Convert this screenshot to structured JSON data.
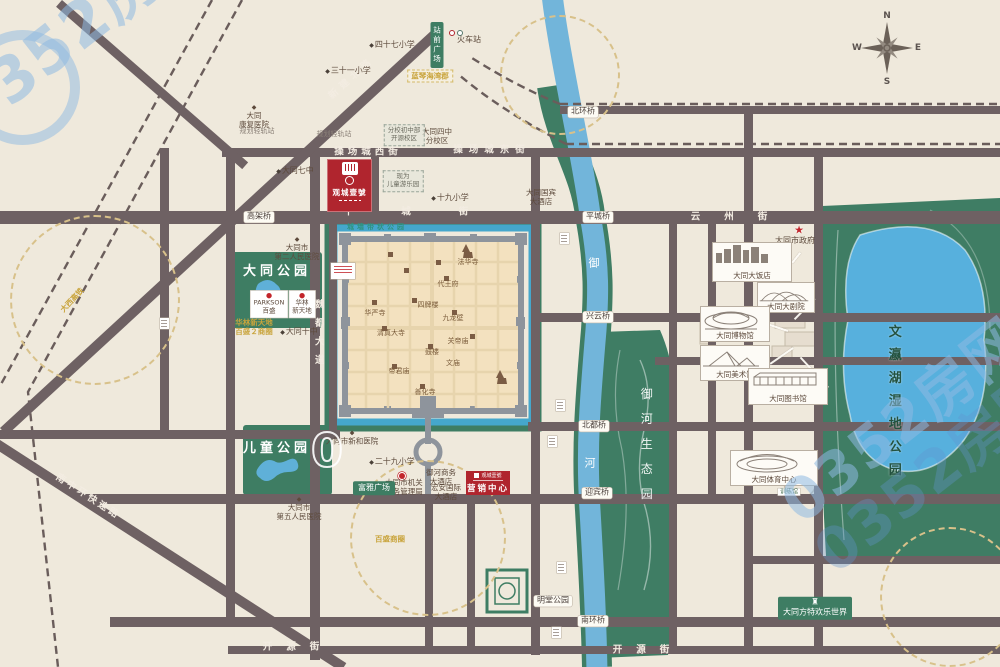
{
  "watermark": {
    "text": "0352房网",
    "zero": "0"
  },
  "compass": {
    "n": "N",
    "s": "S",
    "e": "E",
    "w": "W"
  },
  "project": {
    "name": "观城壹號",
    "marketing_label": "营销中心"
  },
  "map": {
    "labels": [
      {
        "k": "pill",
        "t": "北环桥",
        "x": 583,
        "y": 112,
        "n": "bridge-label-beihuan"
      },
      {
        "k": "pill",
        "t": "平城桥",
        "x": 598,
        "y": 217,
        "n": "bridge-label-pingcheng"
      },
      {
        "k": "pill",
        "t": "兴云桥",
        "x": 598,
        "y": 317,
        "n": "bridge-label-xingyun"
      },
      {
        "k": "pill",
        "t": "北都桥",
        "x": 594,
        "y": 426,
        "n": "bridge-label-beidu"
      },
      {
        "k": "pill",
        "t": "迎宾桥",
        "x": 597,
        "y": 493,
        "n": "bridge-label-yingbin"
      },
      {
        "k": "pill",
        "t": "南环桥",
        "x": 593,
        "y": 621,
        "n": "bridge-label-nanhuan"
      },
      {
        "k": "pill",
        "t": "明堂公园",
        "x": 553,
        "y": 601,
        "n": "mingtang-park-label"
      },
      {
        "k": "pill",
        "t": "高架桥",
        "x": 259,
        "y": 217,
        "n": "viaduct-label"
      },
      {
        "k": "roadtext",
        "t": "操场城西街",
        "x": 368,
        "y": 152,
        "ls": 4,
        "n": "road-name-caochangcheng-west"
      },
      {
        "k": "roadtext",
        "t": "操场城东街",
        "x": 492,
        "y": 150,
        "ls": 6,
        "n": "road-name-caochangcheng-east"
      },
      {
        "k": "roadtext",
        "t": "平城街",
        "x": 430,
        "y": 212,
        "ls": 48,
        "n": "road-name-pingcheng-street"
      },
      {
        "k": "roadtext",
        "t": "云州街",
        "x": 741,
        "y": 217,
        "ls": 24,
        "n": "road-name-yunzhou-street"
      },
      {
        "k": "roadtext",
        "t": "开源街",
        "x": 298,
        "y": 647,
        "ls": 14,
        "n": "road-name-kaiyuan-west"
      },
      {
        "k": "roadtext",
        "t": "开源街",
        "x": 648,
        "y": 650,
        "ls": 14,
        "n": "road-name-kaiyuan-east"
      },
      {
        "k": "roadtext",
        "t": "新建北路",
        "x": 352,
        "y": 78,
        "ls": 5,
        "r": -42,
        "n": "road-name-xinjian-north"
      },
      {
        "k": "roadtext",
        "t": "南中环快速路",
        "x": 88,
        "y": 497,
        "ls": 3,
        "r": 33,
        "n": "road-name-nanzhonghuan"
      },
      {
        "k": "vroad",
        "t": "魏都大道",
        "x": 318,
        "y": 336,
        "ls": 9,
        "n": "road-name-weidu-avenue"
      },
      {
        "k": "rivertext",
        "t": "御",
        "x": 594,
        "y": 263,
        "n": "river-name-yu"
      },
      {
        "k": "rivertext",
        "t": "河",
        "x": 590,
        "y": 463,
        "n": "river-name-he"
      },
      {
        "k": "greenvert",
        "t": "御河生态园",
        "x": 646,
        "y": 450,
        "ls": 13,
        "n": "yuhe-eco-park-label"
      },
      {
        "k": "parkvert",
        "t": "文瀛湖湿地公园",
        "x": 893,
        "y": 405,
        "ls": 10,
        "n": "wenyinghu-wetland-park-label"
      },
      {
        "k": "parkname",
        "t": "大同公园",
        "x": 277,
        "y": 272,
        "ls": 4,
        "n": "datong-park-label"
      },
      {
        "k": "parkname",
        "t": "儿童公园",
        "x": 277,
        "y": 449,
        "ls": 4,
        "n": "children-park-label"
      },
      {
        "k": "moatlabel",
        "t": "城墙带状公园",
        "x": 377,
        "y": 227,
        "ls": 3,
        "n": "city-wall-belt-park-label"
      },
      {
        "k": "citylabel",
        "t": "法华寺",
        "x": 468,
        "y": 262
      },
      {
        "k": "citylabel",
        "t": "代王府",
        "x": 448,
        "y": 284
      },
      {
        "k": "citylabel",
        "t": "九龙壁",
        "x": 453,
        "y": 318
      },
      {
        "k": "citylabel",
        "t": "四牌楼",
        "x": 428,
        "y": 305
      },
      {
        "k": "citylabel",
        "t": "华严寺",
        "x": 375,
        "y": 313
      },
      {
        "k": "citylabel",
        "t": "清真大寺",
        "x": 391,
        "y": 333
      },
      {
        "k": "citylabel",
        "t": "鼓楼",
        "x": 432,
        "y": 352
      },
      {
        "k": "citylabel",
        "t": "关帝庙",
        "x": 458,
        "y": 341
      },
      {
        "k": "citylabel",
        "t": "帝君庙",
        "x": 399,
        "y": 371
      },
      {
        "k": "citylabel",
        "t": "善化寺",
        "x": 425,
        "y": 392
      },
      {
        "k": "citylabel",
        "t": "文庙",
        "x": 453,
        "y": 363
      },
      {
        "k": "school",
        "t": "大同七中",
        "x": 295,
        "y": 171
      },
      {
        "k": "school",
        "t": "三十一小学",
        "x": 348,
        "y": 71
      },
      {
        "k": "school",
        "t": "四十七小学",
        "x": 392,
        "y": 45
      },
      {
        "k": "school",
        "t": "十九小学",
        "x": 450,
        "y": 198
      },
      {
        "k": "school",
        "t": "二十九小学",
        "x": 392,
        "y": 462
      },
      {
        "k": "school",
        "t": "大同十中",
        "x": 299,
        "y": 332
      },
      {
        "k": "poi",
        "t": "火车站",
        "x": 469,
        "y": 40,
        "n": "railway-station-label"
      },
      {
        "k": "poi",
        "t": "大同市政府",
        "x": 795,
        "y": 241,
        "n": "city-government-label"
      },
      {
        "k": "poiD",
        "t": "大同\n康复医院",
        "x": 254,
        "y": 117
      },
      {
        "k": "poiD",
        "t": "大同市\n第二人民医院",
        "x": 297,
        "y": 249
      },
      {
        "k": "poiD",
        "t": "大同市\n第五人民医院",
        "x": 299,
        "y": 509
      },
      {
        "k": "poiD",
        "t": "大同市新和医院",
        "x": 352,
        "y": 438
      },
      {
        "k": "poi2",
        "t": "大同市机关\n事务管理局",
        "x": 404,
        "y": 487
      },
      {
        "k": "poi2",
        "t": "大同国宾\n大酒店",
        "x": 541,
        "y": 197
      },
      {
        "k": "poi2",
        "t": "御河商务\n大酒店",
        "x": 441,
        "y": 477
      },
      {
        "k": "poi2",
        "t": "宏安国际\n大酒店",
        "x": 446,
        "y": 492
      },
      {
        "k": "poi2",
        "t": "大同四中\n分校区",
        "x": 437,
        "y": 136
      },
      {
        "k": "tinygray",
        "t": "规划轻轨站",
        "x": 257,
        "y": 131
      },
      {
        "k": "tinygray",
        "t": "规划轻轨站",
        "x": 334,
        "y": 134
      },
      {
        "k": "yellow",
        "t": "华林新天地\n百盛２商圈",
        "x": 254,
        "y": 327
      },
      {
        "k": "yellow",
        "t": "百盛商圈",
        "x": 390,
        "y": 539
      },
      {
        "k": "yellow",
        "t": "大西高铁",
        "x": 72,
        "y": 300,
        "r": -47
      },
      {
        "k": "ybox",
        "t": "蓝琴海湾郡",
        "x": 430,
        "y": 76
      },
      {
        "k": "shopbox",
        "t": "PARKSON\n百盛",
        "x": 269,
        "y": 304
      },
      {
        "k": "shopbox",
        "t": "华林\n新天地",
        "x": 302,
        "y": 304
      },
      {
        "k": "dashbox",
        "t": "分校初中部\n开源校区",
        "x": 404,
        "y": 135
      },
      {
        "k": "dashbox",
        "t": "现为\n儿童游乐园",
        "x": 403,
        "y": 181
      },
      {
        "k": "greenbox",
        "t": "富雅广场",
        "x": 374,
        "y": 488
      },
      {
        "k": "greenbox castle",
        "t": "大同方特欢乐世界",
        "x": 815,
        "y": 608,
        "n": "fantawild-label"
      },
      {
        "k": "greenvbox",
        "t": "站前广场",
        "x": 437,
        "y": 45,
        "n": "station-square-label"
      },
      {
        "k": "tinybox",
        "t": "体育场",
        "x": 789,
        "y": 472
      },
      {
        "k": "tinybox",
        "t": "游泳馆",
        "x": 789,
        "y": 482
      },
      {
        "k": "tinybox",
        "t": "训练馆",
        "x": 789,
        "y": 492
      },
      {
        "k": "redstar",
        "t": "★",
        "x": 799,
        "y": 230,
        "n": "government-star-icon"
      },
      {
        "k": "wm0",
        "t": "0",
        "x": 327,
        "y": 451,
        "n": "watermark-zero"
      }
    ],
    "callouts": [
      {
        "l": "大同大饭店",
        "x": 712,
        "y": 242,
        "w": 80,
        "h": 40,
        "s": "skyline",
        "tx": 800,
        "ty": 252
      },
      {
        "l": "大同大剧院",
        "x": 757,
        "y": 282,
        "w": 58,
        "h": 31,
        "s": "shell",
        "tx": 795,
        "ty": 318
      },
      {
        "l": "大同博物馆",
        "x": 700,
        "y": 306,
        "w": 70,
        "h": 36,
        "s": "dome",
        "tx": 788,
        "ty": 330
      },
      {
        "l": "大同美术馆",
        "x": 700,
        "y": 345,
        "w": 70,
        "h": 36,
        "s": "pyramid",
        "tx": 793,
        "ty": 347
      },
      {
        "l": "大同图书馆",
        "x": 748,
        "y": 368,
        "w": 80,
        "h": 37,
        "s": "longhall",
        "tx": 800,
        "ty": 356
      },
      {
        "l": "大同体育中心",
        "x": 730,
        "y": 450,
        "w": 88,
        "h": 36,
        "s": "stadium",
        "tx": 797,
        "ty": 480
      }
    ],
    "marks": [
      {
        "k": "mark",
        "x": 560,
        "y": 233
      },
      {
        "k": "mark",
        "x": 556,
        "y": 400
      },
      {
        "k": "mark",
        "x": 548,
        "y": 436
      },
      {
        "k": "mark",
        "x": 557,
        "y": 562
      },
      {
        "k": "mark",
        "x": 552,
        "y": 627
      },
      {
        "k": "mark",
        "x": 160,
        "y": 318
      },
      {
        "k": "mark2",
        "x": 331,
        "y": 263
      },
      {
        "k": "reddot",
        "x": 398,
        "y": 472
      },
      {
        "k": "circleA",
        "x": 449,
        "y": 30
      },
      {
        "k": "circleB",
        "x": 457,
        "y": 30
      }
    ]
  }
}
